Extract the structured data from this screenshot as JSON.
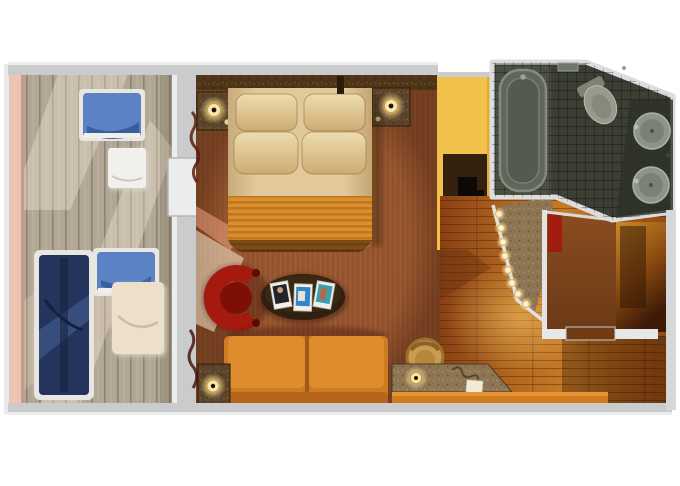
{
  "scene": {
    "type": "floor-plan",
    "subject": "top-down 3D rendered cruise-ship balcony stateroom floor plan",
    "canvas": {
      "width": 680,
      "height": 486
    }
  },
  "palette": {
    "bg": "#ffffff",
    "wall": "#c9cbcd",
    "wall-light": "#e8e9eb",
    "rail-pink": "#ecc4b2",
    "deck": "#b2a694",
    "deck-line": "#93877a",
    "navy": "#24345c",
    "chair-blue": "#5b82c4",
    "chair-blue-dark": "#3a5d9d",
    "table-white": "#f2f0ec",
    "table-cream": "#ece0cb",
    "carpet": "#9a5730",
    "carpet-dark": "#6f3a1c",
    "headboard": "#4e3518",
    "granite-mid": "#5c442b",
    "granite-light": "#8d7452",
    "duvet": "#e2c99c",
    "pillow": "#eedcb0",
    "runner-a": "#d8902f",
    "runner-b": "#c0761b",
    "sofa": "#cf7c20",
    "sofa-dark": "#b5661a",
    "red-chair": "#a6190e",
    "red-chair-dark": "#7d0f06",
    "coffee-table": "#30200f",
    "yellow-wall": "#f2c14b",
    "tv-cabinet": "#33200e",
    "tv-black": "#0d0a06",
    "wood-a": "#8a4014",
    "wood-b": "#c67b26",
    "wood-line": "#4a1e06",
    "desk-orange": "#d07c1d",
    "desk-chair": "#c89a52",
    "bath-tile": "#3b3e33",
    "bath-tile-light": "#4b4f42",
    "fixture": "#8f948a",
    "fixture-light": "#b8bdb0",
    "closet-brown": "#6b3a17",
    "vestibule-amber": "#c98a28",
    "door-brown": "#6f3a14",
    "lamp-glow": "#fff3cf",
    "lamp-ring": "#d9b066",
    "beam": "#f6ead2",
    "salmon-beam": "#f4a98c"
  },
  "rooms": [
    {
      "id": "balcony",
      "name": "private balcony"
    },
    {
      "id": "bedroom-living",
      "name": "combined bedroom and sitting area"
    },
    {
      "id": "corridor",
      "name": "entry corridor with wood floor"
    },
    {
      "id": "bathroom",
      "name": "bathroom with tub, toilet and twin sinks"
    },
    {
      "id": "vestibule",
      "name": "entry vestibule and closet"
    }
  ],
  "furniture": [
    {
      "id": "lounger",
      "room": "balcony",
      "name": "navy chaise lounger"
    },
    {
      "id": "balcony-chair-top",
      "room": "balcony",
      "name": "blue balcony chair"
    },
    {
      "id": "balcony-chair-bottom",
      "room": "balcony",
      "name": "blue balcony chair"
    },
    {
      "id": "balcony-table-top",
      "room": "balcony",
      "name": "small white table"
    },
    {
      "id": "balcony-table-bottom",
      "room": "balcony",
      "name": "small cream table"
    },
    {
      "id": "bed",
      "room": "bedroom-living",
      "name": "twin beds made up as king with four pillows and orange runner"
    },
    {
      "id": "nightstand-left",
      "room": "bedroom-living",
      "name": "granite nightstand with lit lamp"
    },
    {
      "id": "nightstand-right",
      "room": "bedroom-living",
      "name": "granite nightstand with lit lamp"
    },
    {
      "id": "red-armchair",
      "room": "bedroom-living",
      "name": "red barrel armchair"
    },
    {
      "id": "coffee-table",
      "room": "bedroom-living",
      "name": "oval coffee table with three magazines"
    },
    {
      "id": "sofa",
      "room": "bedroom-living",
      "name": "orange two-seat sofa"
    },
    {
      "id": "side-table",
      "room": "bedroom-living",
      "name": "granite side table with lit lamp"
    },
    {
      "id": "tv-unit",
      "room": "bedroom-living",
      "name": "dark media cabinet with flat TV on yellow wall"
    },
    {
      "id": "desk",
      "room": "corridor",
      "name": "granite-top desk with lamp and telephone"
    },
    {
      "id": "desk-chair",
      "room": "corridor",
      "name": "round tan desk chair"
    },
    {
      "id": "vanity",
      "room": "corridor",
      "name": "lighted vanity mirror counter"
    },
    {
      "id": "bathtub",
      "room": "bathroom",
      "name": "bathtub"
    },
    {
      "id": "toilet",
      "room": "bathroom",
      "name": "toilet"
    },
    {
      "id": "sinks",
      "room": "bathroom",
      "name": "two round basins"
    },
    {
      "id": "closet",
      "room": "vestibule",
      "name": "closet with red garment"
    },
    {
      "id": "entry-door",
      "room": "vestibule",
      "name": "cabin entry door"
    }
  ]
}
